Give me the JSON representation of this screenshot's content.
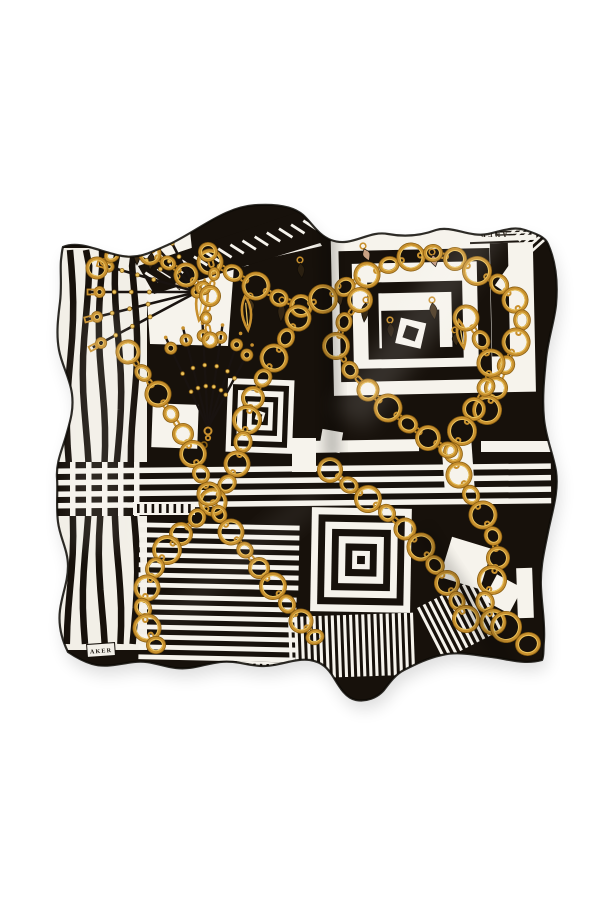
{
  "page": {
    "background": "#ffffff"
  },
  "scarf": {
    "description": "Folded square silk scarf, black and white geometric print with gold chain-link motifs",
    "brand_mark_top_right": "AKER",
    "brand_label_bottom_left": "AKER",
    "palette": {
      "fabric_black": "#17110b",
      "fabric_white": "#f6f3ec",
      "panel_white": "#f2efe7",
      "gold": "#c8902e",
      "gold_dark": "#8a5f12",
      "gold_light": "#ecc45e",
      "tassel_brown": "#3a2b17",
      "tassel_tan": "#c9a183",
      "mark_text": "#352e26",
      "label_text": "#1a150f"
    },
    "motifs": [
      "gold-chain-links",
      "concentric-squares",
      "stripe-blocks",
      "basketweave-check",
      "strap-fans",
      "tassels",
      "diagonal-tick-border"
    ]
  }
}
